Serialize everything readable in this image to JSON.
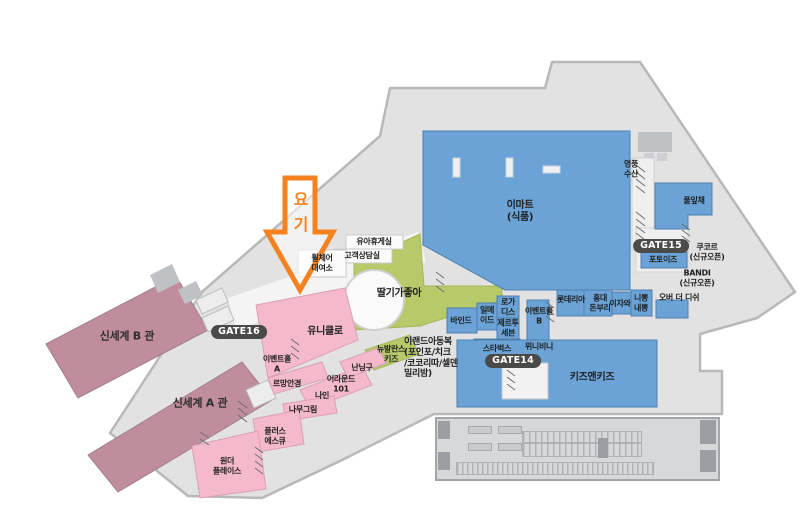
{
  "colors": {
    "mall_gray": "#e2e2e2",
    "mall_outline": "#b8b8b8",
    "mauve": "#bf8d9b",
    "mauve_stroke": "#a37f8d",
    "pink": "#f4bacb",
    "pink_stroke": "#dd9fb4",
    "green": "#b7ca69",
    "green_stroke": "#a4b85a",
    "blue": "#6ba3d6",
    "blue_stroke": "#4d7fae",
    "orange": "#f5821e",
    "badge": "#4a4a48",
    "corridor_white": "#f4f4f4",
    "roof_gray": "#bfc2c4",
    "parking": "#d6d8da",
    "parking_stroke": "#a2a5a9"
  },
  "buildings": {
    "shinsegae_b": "신세계 B 관",
    "shinsegae_a": "신세계 A 관",
    "emart": "이마트\n(식품)",
    "kids_and_kids": "키즈앤키즈",
    "strawberry": "딸기가좋아",
    "uniqlo": "유니클로"
  },
  "shops": {
    "pullipchae": "풀잎채",
    "yeongpung_susan": "영풍\n수산",
    "photoiz": "포토이즈",
    "cucor": "쿠코르\n(신규오픈)",
    "bandi": "BANDI\n(신규오픈)",
    "over_the_dish": "오버 더 디쉬",
    "nippong_naeppong": "니뽕\n내뽕",
    "izawa": "이자와",
    "hongdae_donburi": "홍대\n돈부리",
    "lotteria": "롯데리아",
    "event_hall_b": "이벤트홀\nB",
    "rogatis": "로가\n디스",
    "jertu_seven": "제르투\n세븐",
    "ilmeide": "일메\n이드",
    "bind": "바인드",
    "starbucks": "스타벅스",
    "winnie_binnie": "위니비니",
    "newbalance_kids": "뉴발란스\n키즈",
    "eland_kids": "이랜드아동복\n(포인포/치크\n/코코리따/셀덴\n밀리밤)",
    "event_hall_a": "이벤트홀\nA",
    "lemang_optical": "르망안경",
    "around_101": "어라운드\n101",
    "nine": "나인",
    "nanninggu": "난닝구",
    "namugrim": "나무그림",
    "plus_sq": "플러스\n에스큐",
    "wonder_place": "원더\n플레이스"
  },
  "facilities": {
    "nursing_room": "유아휴게실",
    "customer_service": "고객상담실",
    "wheelchair_rental": "휠체어\n대여소"
  },
  "gates": {
    "gate14": "GATE14",
    "gate15": "GATE15",
    "gate16": "GATE16"
  },
  "marker": {
    "label": "요\n기"
  }
}
